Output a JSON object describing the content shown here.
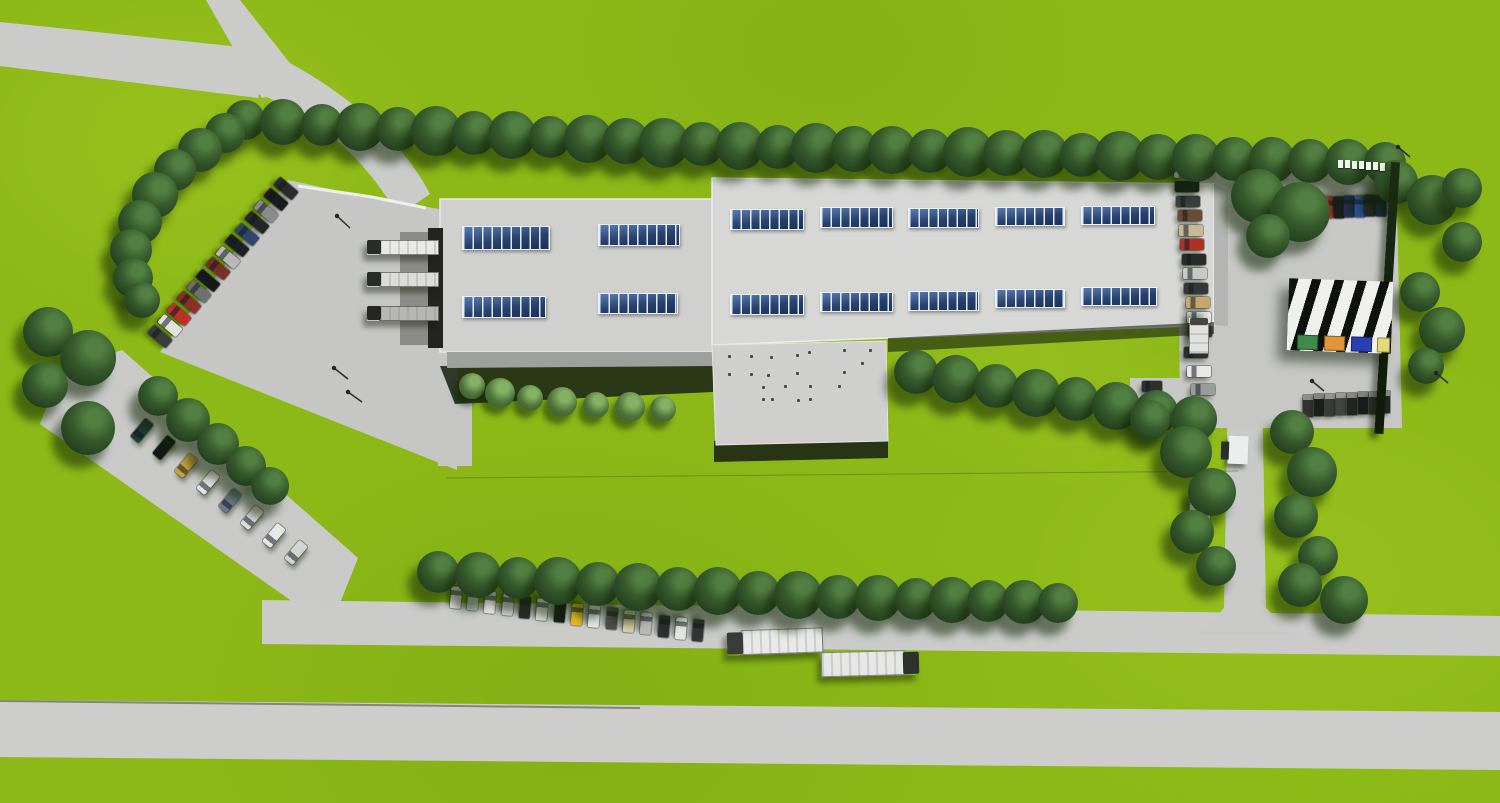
{
  "scene": {
    "description": "Photorealistic aerial 3D rendering of an industrial campus: two connected light-gray factory halls with rows of blue roof skylights, a large concrete yard with loading docks on the west, perimeter tree rows, parking areas filled with cars, a striped waste/recycling shelter, and two white semi-trailer trucks on the access road",
    "canvas": {
      "width": 1500,
      "height": 803
    },
    "colors": {
      "grass": "#8cb917",
      "road": "#cbccca",
      "yard": "#c6c7c5",
      "roof_west": "#d0d1cf",
      "roof_east": "#d7d8d6",
      "roof_annex": "#cfd0ce",
      "facade_east": "#b4b5b2",
      "skylight_blue": "#24406e",
      "tree_dark": "#2c4a25",
      "hedge_dark": "#16240f",
      "shadow_dark": "#1c2415",
      "truck_trailer_white": "#e9eae8",
      "truck_cab_dark": "#35372f"
    },
    "trees": [
      [
        245,
        120,
        40
      ],
      [
        283,
        122,
        46
      ],
      [
        322,
        125,
        42
      ],
      [
        360,
        127,
        48
      ],
      [
        398,
        129,
        44
      ],
      [
        436,
        131,
        50
      ],
      [
        474,
        133,
        44
      ],
      [
        512,
        135,
        48
      ],
      [
        550,
        137,
        42
      ],
      [
        588,
        139,
        48
      ],
      [
        626,
        141,
        46
      ],
      [
        664,
        143,
        50
      ],
      [
        702,
        144,
        44
      ],
      [
        740,
        146,
        48
      ],
      [
        778,
        147,
        44
      ],
      [
        816,
        148,
        50
      ],
      [
        854,
        149,
        46
      ],
      [
        892,
        150,
        48
      ],
      [
        930,
        151,
        44
      ],
      [
        968,
        152,
        50
      ],
      [
        1006,
        153,
        46
      ],
      [
        1044,
        154,
        48
      ],
      [
        1082,
        155,
        44
      ],
      [
        1120,
        156,
        50
      ],
      [
        1158,
        157,
        46
      ],
      [
        1196,
        158,
        48
      ],
      [
        1234,
        159,
        44
      ],
      [
        1272,
        160,
        46
      ],
      [
        1310,
        161,
        44
      ],
      [
        1348,
        162,
        46
      ],
      [
        1385,
        163,
        42
      ],
      [
        225,
        133,
        40
      ],
      [
        200,
        150,
        44
      ],
      [
        175,
        170,
        42
      ],
      [
        155,
        195,
        46
      ],
      [
        140,
        222,
        44
      ],
      [
        131,
        250,
        42
      ],
      [
        133,
        278,
        40
      ],
      [
        142,
        300,
        36
      ],
      [
        48,
        332,
        50
      ],
      [
        88,
        358,
        56
      ],
      [
        45,
        385,
        46
      ],
      [
        88,
        428,
        54
      ],
      [
        158,
        396,
        40
      ],
      [
        188,
        420,
        44
      ],
      [
        218,
        444,
        42
      ],
      [
        246,
        466,
        40
      ],
      [
        270,
        486,
        38
      ],
      [
        916,
        372,
        44
      ],
      [
        956,
        379,
        48
      ],
      [
        996,
        386,
        44
      ],
      [
        1036,
        393,
        48
      ],
      [
        1076,
        399,
        44
      ],
      [
        1116,
        406,
        48
      ],
      [
        1156,
        412,
        44
      ],
      [
        1194,
        419,
        46
      ],
      [
        438,
        572,
        42
      ],
      [
        478,
        575,
        46
      ],
      [
        518,
        578,
        42
      ],
      [
        558,
        581,
        48
      ],
      [
        598,
        584,
        44
      ],
      [
        638,
        587,
        48
      ],
      [
        678,
        589,
        44
      ],
      [
        718,
        591,
        48
      ],
      [
        758,
        593,
        44
      ],
      [
        798,
        595,
        48
      ],
      [
        838,
        597,
        44
      ],
      [
        878,
        598,
        46
      ],
      [
        916,
        599,
        42
      ],
      [
        952,
        600,
        46
      ],
      [
        988,
        601,
        42
      ],
      [
        1024,
        602,
        44
      ],
      [
        1058,
        603,
        40
      ],
      [
        1258,
        196,
        54
      ],
      [
        1300,
        212,
        60
      ],
      [
        1268,
        236,
        44
      ],
      [
        1396,
        182,
        44
      ],
      [
        1432,
        200,
        50
      ],
      [
        1462,
        188,
        40
      ],
      [
        1420,
        292,
        40
      ],
      [
        1442,
        330,
        46
      ],
      [
        1426,
        366,
        36
      ],
      [
        1462,
        242,
        40
      ],
      [
        1186,
        452,
        52
      ],
      [
        1212,
        492,
        48
      ],
      [
        1192,
        532,
        44
      ],
      [
        1216,
        566,
        40
      ],
      [
        1150,
        420,
        40
      ],
      [
        1292,
        432,
        44
      ],
      [
        1312,
        472,
        50
      ],
      [
        1296,
        516,
        44
      ],
      [
        1318,
        556,
        40
      ],
      [
        1300,
        585,
        44
      ],
      [
        1344,
        600,
        48
      ]
    ],
    "bushes": [
      [
        472,
        386,
        26
      ],
      [
        500,
        393,
        30
      ],
      [
        530,
        398,
        26
      ],
      [
        562,
        402,
        30
      ],
      [
        596,
        405,
        26
      ],
      [
        630,
        407,
        30
      ],
      [
        663,
        409,
        26
      ]
    ],
    "cars": [
      {
        "x": 286,
        "y": 188,
        "a": 40,
        "c": "#2a2c2b"
      },
      {
        "x": 276,
        "y": 199,
        "a": 40,
        "c": "#1b1d1c"
      },
      {
        "x": 266,
        "y": 211,
        "a": 40,
        "c": "#8a8c8b"
      },
      {
        "x": 257,
        "y": 222,
        "a": 40,
        "c": "#242628"
      },
      {
        "x": 247,
        "y": 234,
        "a": 40,
        "c": "#30456e"
      },
      {
        "x": 237,
        "y": 245,
        "a": 40,
        "c": "#1e201f"
      },
      {
        "x": 228,
        "y": 257,
        "a": 40,
        "c": "#b8b9b7"
      },
      {
        "x": 218,
        "y": 268,
        "a": 40,
        "c": "#7a2e28"
      },
      {
        "x": 208,
        "y": 280,
        "a": 40,
        "c": "#16181a"
      },
      {
        "x": 199,
        "y": 291,
        "a": 40,
        "c": "#6e7070"
      },
      {
        "x": 189,
        "y": 302,
        "a": 40,
        "c": "#8e2e2a"
      },
      {
        "x": 179,
        "y": 314,
        "a": 40,
        "c": "#c03028"
      },
      {
        "x": 170,
        "y": 325,
        "a": 40,
        "c": "#e2e3e1"
      },
      {
        "x": 160,
        "y": 336,
        "a": 40,
        "c": "#3a3c3b"
      },
      {
        "x": 142,
        "y": 430,
        "a": -50,
        "c": "#1e3a34"
      },
      {
        "x": 164,
        "y": 447,
        "a": -50,
        "c": "#141615"
      },
      {
        "x": 186,
        "y": 465,
        "a": -50,
        "c": "#c8a23a"
      },
      {
        "x": 208,
        "y": 482,
        "a": -50,
        "c": "#e4e5e3"
      },
      {
        "x": 230,
        "y": 500,
        "a": -50,
        "c": "#6a7a8a"
      },
      {
        "x": 252,
        "y": 517,
        "a": -50,
        "c": "#dededc"
      },
      {
        "x": 274,
        "y": 535,
        "a": -50,
        "c": "#e8e8e6"
      },
      {
        "x": 296,
        "y": 552,
        "a": -50,
        "c": "#d4d5d3"
      },
      {
        "x": 456,
        "y": 597,
        "a": 95,
        "w": 22,
        "c": "#e6e7e5"
      },
      {
        "x": 473,
        "y": 599,
        "a": 95,
        "w": 22,
        "c": "#c8c9c7"
      },
      {
        "x": 490,
        "y": 602,
        "a": 95,
        "w": 22,
        "c": "#e2e3e1"
      },
      {
        "x": 508,
        "y": 604,
        "a": 95,
        "w": 22,
        "c": "#dadbd9"
      },
      {
        "x": 525,
        "y": 607,
        "a": 95,
        "w": 22,
        "c": "#2a2c2b"
      },
      {
        "x": 542,
        "y": 609,
        "a": 95,
        "w": 22,
        "c": "#e8e8e6"
      },
      {
        "x": 560,
        "y": 611,
        "a": 95,
        "w": 22,
        "c": "#1a1c1b"
      },
      {
        "x": 577,
        "y": 614,
        "a": 95,
        "w": 22,
        "c": "#e0b820"
      },
      {
        "x": 594,
        "y": 616,
        "a": 95,
        "w": 22,
        "c": "#e6e6e4"
      },
      {
        "x": 612,
        "y": 618,
        "a": 95,
        "w": 22,
        "c": "#4a4c4b"
      },
      {
        "x": 629,
        "y": 621,
        "a": 95,
        "w": 22,
        "c": "#d8cfa8"
      },
      {
        "x": 646,
        "y": 623,
        "a": 95,
        "w": 22,
        "c": "#b8b9b7"
      },
      {
        "x": 664,
        "y": 626,
        "a": 95,
        "w": 22,
        "c": "#2e302f"
      },
      {
        "x": 681,
        "y": 628,
        "a": 95,
        "w": 22,
        "c": "#e4e4e2"
      },
      {
        "x": 698,
        "y": 630,
        "a": 95,
        "w": 22,
        "c": "#343635"
      },
      {
        "x": 1186,
        "y": 172,
        "a": 0,
        "c": "#e8e8e6"
      },
      {
        "x": 1187,
        "y": 186,
        "a": 0,
        "c": "#1d1f1e"
      },
      {
        "x": 1188,
        "y": 201,
        "a": 0,
        "c": "#3c3e3c"
      },
      {
        "x": 1190,
        "y": 215,
        "a": 0,
        "c": "#6b4a36"
      },
      {
        "x": 1191,
        "y": 230,
        "a": 0,
        "c": "#c9b896"
      },
      {
        "x": 1192,
        "y": 244,
        "a": 0,
        "c": "#b03028"
      },
      {
        "x": 1194,
        "y": 259,
        "a": 0,
        "c": "#2a2c2a"
      },
      {
        "x": 1195,
        "y": 273,
        "a": 0,
        "c": "#c8c9c7"
      },
      {
        "x": 1196,
        "y": 288,
        "a": 0,
        "c": "#35373a"
      },
      {
        "x": 1198,
        "y": 302,
        "a": 0,
        "c": "#c9a66b"
      },
      {
        "x": 1199,
        "y": 317,
        "a": 0,
        "c": "#e6e6e4"
      },
      {
        "x": 1200,
        "y": 331,
        "a": 0,
        "c": "#2e3030"
      },
      {
        "x": 1196,
        "y": 352,
        "a": 0,
        "c": "#2e302f"
      },
      {
        "x": 1199,
        "y": 371,
        "a": 0,
        "c": "#e8e8e6"
      },
      {
        "x": 1203,
        "y": 389,
        "a": 0,
        "c": "#9a9c9a"
      },
      {
        "x": 1152,
        "y": 386,
        "a": 0,
        "w": 20,
        "c": "#2e302f"
      },
      {
        "x": 1318,
        "y": 208,
        "a": 90,
        "w": 22,
        "c": "#8a8c8a"
      },
      {
        "x": 1328,
        "y": 207,
        "a": 90,
        "w": 22,
        "c": "#b8342c"
      },
      {
        "x": 1339,
        "y": 207,
        "a": 90,
        "w": 22,
        "c": "#1e201f"
      },
      {
        "x": 1349,
        "y": 206,
        "a": 90,
        "w": 22,
        "c": "#22304d"
      },
      {
        "x": 1360,
        "y": 206,
        "a": 90,
        "w": 22,
        "c": "#2e4f8e"
      },
      {
        "x": 1370,
        "y": 205,
        "a": 90,
        "w": 22,
        "c": "#26282a"
      },
      {
        "x": 1381,
        "y": 205,
        "a": 90,
        "w": 22,
        "c": "#1b2d52"
      }
    ],
    "vans": [
      {
        "x": 1308,
        "y": 395,
        "c": "#303231"
      },
      {
        "x": 1319,
        "y": 394,
        "c": "#1c1e1d"
      },
      {
        "x": 1330,
        "y": 394,
        "c": "#3a3c3b"
      },
      {
        "x": 1341,
        "y": 393,
        "c": "#434544"
      },
      {
        "x": 1352,
        "y": 393,
        "c": "#222423"
      },
      {
        "x": 1363,
        "y": 392,
        "c": "#1a1c1b"
      },
      {
        "x": 1374,
        "y": 392,
        "c": "#2e302f"
      },
      {
        "x": 1385,
        "y": 391,
        "c": "#242625"
      }
    ],
    "trucks": [
      {
        "cx": 775,
        "cy": 641,
        "w": 96,
        "h": 25,
        "a": -2,
        "cab": "left",
        "tc": "#e9eae8",
        "cc": "#3a3c39"
      },
      {
        "cx": 870,
        "cy": 663,
        "w": 98,
        "h": 25,
        "a": -1.5,
        "cab": "right",
        "tc": "#e6e7e5",
        "cc": "#2e302d"
      },
      {
        "cx": 403,
        "cy": 247,
        "w": 72,
        "h": 15,
        "a": 0,
        "cab": "left",
        "tc": "#e8e9e7",
        "cc": "#2a2c28"
      },
      {
        "cx": 403,
        "cy": 279,
        "w": 72,
        "h": 15,
        "a": 0,
        "cab": "left",
        "tc": "#dcdddb",
        "cc": "#2a2c28"
      },
      {
        "cx": 403,
        "cy": 313,
        "w": 72,
        "h": 15,
        "a": 0,
        "cab": "left",
        "tc": "#b6b7b5",
        "cc": "#24261f"
      },
      {
        "cx": 1199,
        "cy": 336,
        "w": 36,
        "h": 20,
        "a": 90,
        "cab": "left",
        "tc": "#e2e3e1",
        "cc": "#44463f"
      },
      {
        "cx": 1200,
        "cy": 524,
        "w": 44,
        "h": 22,
        "a": 90,
        "cab": "right",
        "tc": "#e8e9e7",
        "cc": "#3a3c36"
      }
    ],
    "skylights": [
      {
        "x": 462,
        "y": 226,
        "w": 88,
        "h": 24
      },
      {
        "x": 598,
        "y": 224,
        "w": 82,
        "h": 22
      },
      {
        "x": 462,
        "y": 296,
        "w": 84,
        "h": 22
      },
      {
        "x": 598,
        "y": 293,
        "w": 80,
        "h": 21
      },
      {
        "x": 730,
        "y": 209,
        "w": 74,
        "h": 21
      },
      {
        "x": 820,
        "y": 207,
        "w": 73,
        "h": 21
      },
      {
        "x": 908,
        "y": 208,
        "w": 71,
        "h": 20
      },
      {
        "x": 995,
        "y": 207,
        "w": 70,
        "h": 19
      },
      {
        "x": 1081,
        "y": 206,
        "w": 74,
        "h": 19
      },
      {
        "x": 730,
        "y": 294,
        "w": 74,
        "h": 21
      },
      {
        "x": 820,
        "y": 292,
        "w": 73,
        "h": 20
      },
      {
        "x": 908,
        "y": 291,
        "w": 71,
        "h": 20
      },
      {
        "x": 995,
        "y": 289,
        "w": 70,
        "h": 19
      },
      {
        "x": 1081,
        "y": 287,
        "w": 76,
        "h": 19
      }
    ],
    "roof_vents": [
      [
        728,
        355
      ],
      [
        750,
        355
      ],
      [
        770,
        356
      ],
      [
        796,
        354
      ],
      [
        808,
        351
      ],
      [
        843,
        349
      ],
      [
        869,
        349
      ],
      [
        861,
        362
      ],
      [
        728,
        373
      ],
      [
        750,
        373
      ],
      [
        767,
        374
      ],
      [
        796,
        372
      ],
      [
        843,
        371
      ],
      [
        762,
        386
      ],
      [
        784,
        385
      ],
      [
        809,
        385
      ],
      [
        838,
        385
      ],
      [
        762,
        398
      ],
      [
        771,
        398
      ],
      [
        797,
        399
      ],
      [
        809,
        398
      ]
    ],
    "fence_posts": [
      [
        1338,
        160
      ],
      [
        1345,
        160
      ],
      [
        1352,
        161
      ],
      [
        1359,
        161
      ],
      [
        1366,
        162
      ],
      [
        1373,
        162
      ],
      [
        1380,
        163
      ]
    ],
    "poles": [
      [
        337,
        216,
        350,
        228
      ],
      [
        334,
        368,
        348,
        379
      ],
      [
        348,
        392,
        362,
        402
      ],
      [
        1312,
        381,
        1324,
        391
      ],
      [
        1398,
        147,
        1410,
        157
      ],
      [
        1436,
        373,
        1448,
        383
      ]
    ],
    "waste_station": {
      "container_colors": [
        "#3e8a4a",
        "#e09638",
        "#2b3fb4",
        "#e3dc74"
      ]
    }
  }
}
